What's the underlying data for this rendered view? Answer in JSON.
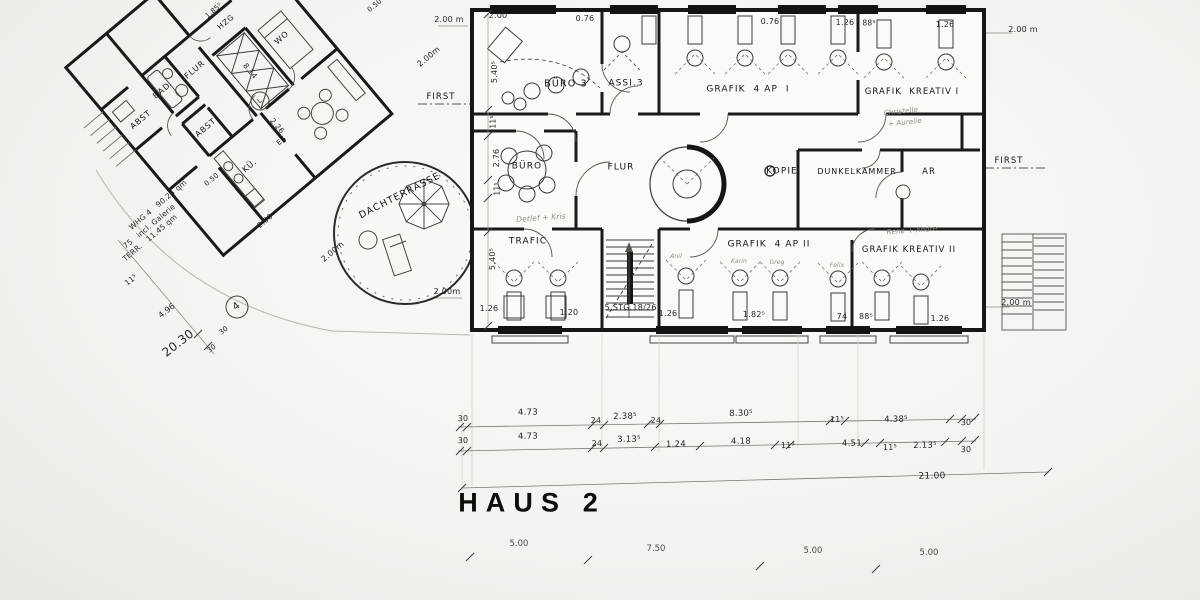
{
  "sheet": {
    "title": "HAUS 2"
  },
  "haus2": {
    "rooms": [
      "BÜRO 3",
      "ASSI.3",
      "GRAFIK 4 AP I",
      "GRAFIK KREATIV I",
      "BÜRO",
      "FLUR",
      "KOPIE",
      "DUNKELKAMMER",
      "AR",
      "TRAFIC",
      "GRAFIK 4 AP II",
      "GRAFIK KREATIV II"
    ],
    "stair_label": "15 STG.18/26",
    "total_width": "21.00",
    "dim_row_upper": [
      "30",
      "4.73",
      "24",
      "2.38⁵",
      "24",
      "8.30⁵",
      "11⁵",
      "4.38⁵",
      "30"
    ],
    "dim_row_lower": [
      "30",
      "4.73",
      "24",
      "3.13⁵",
      "1.24",
      "4.18",
      "11⁵",
      "4.51",
      "11⁵",
      "2.13⁵",
      "30"
    ],
    "grid_dims": [
      "5.00",
      "7.50",
      "5.00",
      "5.00"
    ]
  },
  "whg4": {
    "rooms": [
      "FLUR",
      "BAD",
      "ABST",
      "ABST",
      "KÜ.",
      "WO",
      "HZG",
      "ES",
      "DACHTERRASSE"
    ],
    "area_note": [
      "WHG 4   90.24 qm",
      "incl. Galerie",
      "TERR.   11.45 qm"
    ],
    "dims": [
      "75",
      "11⁵",
      "4.96",
      "20.30",
      "8.14",
      "2.26",
      "0.50",
      "2.00",
      "1.85⁵"
    ]
  },
  "ridge_label": "FIRST",
  "annotations": [
    {
      "name": "room-label-buero3",
      "text": "BÜRO 3",
      "x": 566,
      "y": 84,
      "rot": 0,
      "size": 9.5,
      "cls": "label"
    },
    {
      "name": "room-label-assi3",
      "text": "ASSI.3",
      "x": 626,
      "y": 84,
      "rot": 0,
      "size": 9,
      "cls": "label"
    },
    {
      "name": "room-label-grafik-4ap-1",
      "text": "GRAFIK  4 AP  I",
      "x": 748,
      "y": 90,
      "rot": 0,
      "size": 9,
      "cls": "label"
    },
    {
      "name": "room-label-grafik-kreativ-1",
      "text": "GRAFIK  KREATIV I",
      "x": 912,
      "y": 92,
      "rot": 0,
      "size": 8.5,
      "cls": "label"
    },
    {
      "name": "room-label-buero",
      "text": "BÜRO",
      "x": 527,
      "y": 167,
      "rot": 0,
      "size": 9,
      "cls": "label"
    },
    {
      "name": "room-label-flur-haus2",
      "text": "FLUR",
      "x": 621,
      "y": 168,
      "rot": 0,
      "size": 9,
      "cls": "label"
    },
    {
      "name": "room-label-kopie",
      "text": "KOPIE",
      "x": 782,
      "y": 172,
      "rot": 0,
      "size": 9,
      "cls": "label"
    },
    {
      "name": "room-label-dunkelkammer",
      "text": "DUNKELKAMMER",
      "x": 857,
      "y": 172,
      "rot": 0,
      "size": 8,
      "cls": "label"
    },
    {
      "name": "room-label-ar",
      "text": "AR",
      "x": 929,
      "y": 172,
      "rot": 0,
      "size": 8.5,
      "cls": "label"
    },
    {
      "name": "room-label-trafic",
      "text": "TRAFIC",
      "x": 528,
      "y": 242,
      "rot": 0,
      "size": 9,
      "cls": "label"
    },
    {
      "name": "room-label-grafik-4ap-2",
      "text": "GRAFIK  4 AP II",
      "x": 769,
      "y": 245,
      "rot": 0,
      "size": 9,
      "cls": "label"
    },
    {
      "name": "room-label-grafik-kreativ-2",
      "text": "GRAFIK KREATIV II",
      "x": 909,
      "y": 250,
      "rot": 0,
      "size": 8.5,
      "cls": "label"
    },
    {
      "name": "stair-label",
      "text": "15 STG.18/26",
      "x": 628,
      "y": 308,
      "rot": 0,
      "size": 8,
      "cls": "dim"
    },
    {
      "name": "room-label-flur-whg",
      "text": "FLUR",
      "x": 195,
      "y": 70,
      "rot": -40,
      "size": 8,
      "cls": "label"
    },
    {
      "name": "room-label-bad",
      "text": "BAD",
      "x": 162,
      "y": 91,
      "rot": -40,
      "size": 8,
      "cls": "label"
    },
    {
      "name": "room-label-abst-1",
      "text": "ABST",
      "x": 141,
      "y": 120,
      "rot": -40,
      "size": 8,
      "cls": "label"
    },
    {
      "name": "room-label-abst-2",
      "text": "ABST",
      "x": 206,
      "y": 128,
      "rot": -40,
      "size": 8,
      "cls": "label"
    },
    {
      "name": "room-label-kueche",
      "text": "KÜ.",
      "x": 250,
      "y": 166,
      "rot": -40,
      "size": 8,
      "cls": "label"
    },
    {
      "name": "room-label-wo",
      "text": "WO",
      "x": 282,
      "y": 38,
      "rot": -40,
      "size": 8,
      "cls": "label"
    },
    {
      "name": "room-label-hzg",
      "text": "HZG",
      "x": 226,
      "y": 22,
      "rot": -40,
      "size": 7.5,
      "cls": "label"
    },
    {
      "name": "room-label-es",
      "text": "ES",
      "x": 282,
      "y": 141,
      "rot": -40,
      "size": 7,
      "cls": "label"
    },
    {
      "name": "terrace-label",
      "text": "DACHTERRASSE",
      "x": 400,
      "y": 196,
      "rot": -27,
      "size": 9.5,
      "cls": "label"
    },
    {
      "name": "whg-area-line1",
      "text": "WHG 4   90.24 qm",
      "x": 158,
      "y": 205,
      "rot": -40,
      "size": 7.5,
      "cls": "dim"
    },
    {
      "name": "whg-area-line2",
      "text": "incl. Galerie",
      "x": 156,
      "y": 221,
      "rot": -40,
      "size": 7.5,
      "cls": "dim"
    },
    {
      "name": "whg-area-line3",
      "text": "TERR.   11.45 qm",
      "x": 150,
      "y": 238,
      "rot": -40,
      "size": 7.5,
      "cls": "dim"
    },
    {
      "name": "sheet-title",
      "text": "HAUS 2",
      "x": 532,
      "y": 503,
      "rot": 0,
      "size": 27,
      "cls": "title"
    },
    {
      "name": "dim-top-1",
      "text": "2.00",
      "x": 498,
      "y": 16,
      "rot": 0,
      "size": 8,
      "cls": "dim"
    },
    {
      "name": "dim-top-2",
      "text": "0.76",
      "x": 585,
      "y": 19,
      "rot": 0,
      "size": 8,
      "cls": "dim"
    },
    {
      "name": "dim-top-3",
      "text": "0.76",
      "x": 770,
      "y": 22,
      "rot": 0,
      "size": 8,
      "cls": "dim"
    },
    {
      "name": "dim-top-4",
      "text": "1.26",
      "x": 845,
      "y": 23,
      "rot": 0,
      "size": 8,
      "cls": "dim"
    },
    {
      "name": "dim-top-5",
      "text": "88⁵",
      "x": 869,
      "y": 23,
      "rot": 0,
      "size": 7.5,
      "cls": "dim"
    },
    {
      "name": "dim-top-6",
      "text": "1.26",
      "x": 945,
      "y": 25,
      "rot": 0,
      "size": 8,
      "cls": "dim"
    },
    {
      "name": "dim-west-1",
      "text": "5.40⁵",
      "x": 495,
      "y": 72,
      "rot": -90,
      "size": 8,
      "cls": "dim"
    },
    {
      "name": "dim-west-2",
      "text": "11⁵",
      "x": 493,
      "y": 122,
      "rot": -90,
      "size": 7.5,
      "cls": "dim"
    },
    {
      "name": "dim-west-3",
      "text": "2.76",
      "x": 497,
      "y": 158,
      "rot": -90,
      "size": 8,
      "cls": "dim"
    },
    {
      "name": "dim-west-4",
      "text": "11⁵",
      "x": 497,
      "y": 189,
      "rot": -90,
      "size": 7.5,
      "cls": "dim"
    },
    {
      "name": "dim-west-5",
      "text": "5.40⁵",
      "x": 493,
      "y": 259,
      "rot": -90,
      "size": 8,
      "cls": "dim"
    },
    {
      "name": "dim-south-1",
      "text": "1.26",
      "x": 489,
      "y": 309,
      "rot": 0,
      "size": 8,
      "cls": "dim"
    },
    {
      "name": "dim-south-2",
      "text": "1.20",
      "x": 569,
      "y": 313,
      "rot": 0,
      "size": 8,
      "cls": "dim"
    },
    {
      "name": "dim-south-3",
      "text": "1.26",
      "x": 668,
      "y": 314,
      "rot": 0,
      "size": 8,
      "cls": "dim"
    },
    {
      "name": "dim-south-4",
      "text": "1.82⁵",
      "x": 754,
      "y": 315,
      "rot": 0,
      "size": 8,
      "cls": "dim"
    },
    {
      "name": "dim-south-5",
      "text": "74",
      "x": 842,
      "y": 317,
      "rot": 0,
      "size": 8,
      "cls": "dim"
    },
    {
      "name": "dim-south-6",
      "text": "88⁵",
      "x": 866,
      "y": 317,
      "rot": 0,
      "size": 8,
      "cls": "dim"
    },
    {
      "name": "dim-south-7",
      "text": "1.26",
      "x": 940,
      "y": 319,
      "rot": 0,
      "size": 8,
      "cls": "dim"
    },
    {
      "name": "dimrow1-1",
      "text": "30",
      "x": 463,
      "y": 419,
      "rot": -1,
      "size": 8,
      "cls": "dim"
    },
    {
      "name": "dimrow1-2",
      "text": "4.73",
      "x": 528,
      "y": 413,
      "rot": -1,
      "size": 8.5,
      "cls": "dim"
    },
    {
      "name": "dimrow1-3",
      "text": "24",
      "x": 596,
      "y": 421,
      "rot": -1,
      "size": 8,
      "cls": "dim"
    },
    {
      "name": "dimrow1-4",
      "text": "2.38⁵",
      "x": 625,
      "y": 417,
      "rot": -1,
      "size": 8.5,
      "cls": "dim"
    },
    {
      "name": "dimrow1-5",
      "text": "24",
      "x": 656,
      "y": 421,
      "rot": -1,
      "size": 8,
      "cls": "dim"
    },
    {
      "name": "dimrow1-6",
      "text": "8.30⁵",
      "x": 741,
      "y": 414,
      "rot": -1,
      "size": 8.5,
      "cls": "dim"
    },
    {
      "name": "dimrow1-7",
      "text": "11⁵",
      "x": 837,
      "y": 420,
      "rot": -1,
      "size": 8,
      "cls": "dim"
    },
    {
      "name": "dimrow1-8",
      "text": "4.38⁵",
      "x": 896,
      "y": 420,
      "rot": -1,
      "size": 8.5,
      "cls": "dim"
    },
    {
      "name": "dimrow1-9",
      "text": "30",
      "x": 966,
      "y": 423,
      "rot": -1,
      "size": 8,
      "cls": "dim"
    },
    {
      "name": "dimrow2-1",
      "text": "30",
      "x": 463,
      "y": 441,
      "rot": -1,
      "size": 8,
      "cls": "dim"
    },
    {
      "name": "dimrow2-2",
      "text": "4.73",
      "x": 528,
      "y": 437,
      "rot": -1,
      "size": 8.5,
      "cls": "dim"
    },
    {
      "name": "dimrow2-3",
      "text": "24",
      "x": 597,
      "y": 444,
      "rot": -1,
      "size": 8,
      "cls": "dim"
    },
    {
      "name": "dimrow2-4",
      "text": "3.13⁵",
      "x": 629,
      "y": 440,
      "rot": -1,
      "size": 8.5,
      "cls": "dim"
    },
    {
      "name": "dimrow2-5",
      "text": "1.24",
      "x": 676,
      "y": 445,
      "rot": -1,
      "size": 8.5,
      "cls": "dim"
    },
    {
      "name": "dimrow2-6",
      "text": "4.18",
      "x": 741,
      "y": 442,
      "rot": -1,
      "size": 8.5,
      "cls": "dim"
    },
    {
      "name": "dimrow2-7",
      "text": "11⁵",
      "x": 788,
      "y": 446,
      "rot": -1,
      "size": 8,
      "cls": "dim"
    },
    {
      "name": "dimrow2-8",
      "text": "4.51",
      "x": 852,
      "y": 444,
      "rot": -1,
      "size": 8.5,
      "cls": "dim"
    },
    {
      "name": "dimrow2-9",
      "text": "11⁵",
      "x": 890,
      "y": 448,
      "rot": -1,
      "size": 8,
      "cls": "dim"
    },
    {
      "name": "dimrow2-10",
      "text": "2.13⁵",
      "x": 925,
      "y": 446,
      "rot": -1,
      "size": 8.5,
      "cls": "dim"
    },
    {
      "name": "dimrow2-11",
      "text": "30",
      "x": 966,
      "y": 450,
      "rot": -1,
      "size": 8,
      "cls": "dim"
    },
    {
      "name": "dim-total",
      "text": "21.00",
      "x": 932,
      "y": 477,
      "rot": -1,
      "size": 9,
      "cls": "dim"
    },
    {
      "name": "grid-dim-1",
      "text": "5.00",
      "x": 519,
      "y": 544,
      "rot": 0,
      "size": 8.5,
      "cls": "faint"
    },
    {
      "name": "grid-dim-2",
      "text": "7.50",
      "x": 656,
      "y": 549,
      "rot": 0,
      "size": 8.5,
      "cls": "faint"
    },
    {
      "name": "grid-dim-3",
      "text": "5.00",
      "x": 813,
      "y": 551,
      "rot": 0,
      "size": 8.5,
      "cls": "faint"
    },
    {
      "name": "grid-dim-4",
      "text": "5.00",
      "x": 929,
      "y": 553,
      "rot": 0,
      "size": 8.5,
      "cls": "faint"
    },
    {
      "name": "meter-nw-1",
      "text": "2.00 m",
      "x": 449,
      "y": 20,
      "rot": 0,
      "size": 8,
      "cls": "dim"
    },
    {
      "name": "meter-nw-2",
      "text": "2.00m",
      "x": 429,
      "y": 57,
      "rot": -40,
      "size": 8,
      "cls": "dim"
    },
    {
      "name": "meter-ne",
      "text": "2.00 m",
      "x": 1023,
      "y": 30,
      "rot": 0,
      "size": 8,
      "cls": "dim"
    },
    {
      "name": "meter-se",
      "text": "2.00 m",
      "x": 1016,
      "y": 303,
      "rot": 0,
      "size": 8,
      "cls": "dim"
    },
    {
      "name": "meter-terrace",
      "text": "2.00m",
      "x": 447,
      "y": 292,
      "rot": 0,
      "size": 8,
      "cls": "dim"
    },
    {
      "name": "meter-sw",
      "text": "2.00m",
      "x": 333,
      "y": 252,
      "rot": -40,
      "size": 8,
      "cls": "dim"
    },
    {
      "name": "dim-whg-200",
      "text": "2.00",
      "x": 265,
      "y": 221,
      "rot": -40,
      "size": 7.5,
      "cls": "dim"
    },
    {
      "name": "dim-whg-050a",
      "text": "0.50",
      "x": 212,
      "y": 180,
      "rot": -40,
      "size": 7,
      "cls": "dim"
    },
    {
      "name": "dim-whg-050b",
      "text": "0.50",
      "x": 375,
      "y": 6,
      "rot": -40,
      "size": 7,
      "cls": "dim"
    },
    {
      "name": "dim-whg-814",
      "text": "8.14",
      "x": 250,
      "y": 71,
      "rot": 50,
      "size": 7.5,
      "cls": "dim"
    },
    {
      "name": "dim-whg-226",
      "text": "2.26",
      "x": 277,
      "y": 126,
      "rot": 50,
      "size": 7.5,
      "cls": "dim"
    },
    {
      "name": "dim-whg-185",
      "text": "1.85⁵",
      "x": 214,
      "y": 11,
      "rot": -40,
      "size": 7,
      "cls": "dim"
    },
    {
      "name": "ridge-label-west",
      "text": "FIRST",
      "x": 441,
      "y": 97,
      "rot": 0,
      "size": 8.5,
      "cls": "label"
    },
    {
      "name": "ridge-label-east",
      "text": "FIRST",
      "x": 1009,
      "y": 161,
      "rot": 0,
      "size": 8.5,
      "cls": "label"
    },
    {
      "name": "dim-site-75",
      "text": "75",
      "x": 128,
      "y": 244,
      "rot": -38,
      "size": 7.5,
      "cls": "dim"
    },
    {
      "name": "dim-site-115",
      "text": "11⁵",
      "x": 131,
      "y": 280,
      "rot": -38,
      "size": 7.5,
      "cls": "dim"
    },
    {
      "name": "dim-site-496",
      "text": "4.96",
      "x": 167,
      "y": 311,
      "rot": -38,
      "size": 8,
      "cls": "dim"
    },
    {
      "name": "dim-site-2030",
      "text": "20.30",
      "x": 178,
      "y": 343,
      "rot": -38,
      "size": 12,
      "cls": "dim"
    },
    {
      "name": "dim-site-30a",
      "text": "30",
      "x": 224,
      "y": 331,
      "rot": -38,
      "size": 7,
      "cls": "dim"
    },
    {
      "name": "dim-site-30b",
      "text": "30",
      "x": 212,
      "y": 349,
      "rot": -38,
      "size": 7,
      "cls": "dim"
    },
    {
      "name": "marker-l",
      "text": "L",
      "x": 260,
      "y": 101,
      "rot": -40,
      "size": 7,
      "cls": "dim"
    },
    {
      "name": "marker-4",
      "text": "4",
      "x": 237,
      "y": 307,
      "rot": -38,
      "size": 10,
      "cls": "dim"
    },
    {
      "name": "handwriting-trafic",
      "text": "Detlef + Kris",
      "x": 541,
      "y": 218,
      "rot": -4,
      "size": 7.5,
      "cls": "hand"
    },
    {
      "name": "handwriting-kreativ1-a",
      "text": "Christelle",
      "x": 901,
      "y": 112,
      "rot": -6,
      "size": 7,
      "cls": "hand"
    },
    {
      "name": "handwriting-kreativ1-b",
      "text": "+ Aurelie",
      "x": 905,
      "y": 123,
      "rot": -6,
      "size": 7,
      "cls": "hand"
    },
    {
      "name": "handwriting-kreativ2",
      "text": "Rene + Andre",
      "x": 912,
      "y": 231,
      "rot": -4,
      "size": 7,
      "cls": "hand"
    },
    {
      "name": "handwriting-desk-1",
      "text": "Anil",
      "x": 676,
      "y": 257,
      "rot": 0,
      "size": 6,
      "cls": "hand"
    },
    {
      "name": "handwriting-desk-2",
      "text": "Karin",
      "x": 739,
      "y": 262,
      "rot": 0,
      "size": 6,
      "cls": "hand"
    },
    {
      "name": "handwriting-desk-3",
      "text": "Greg",
      "x": 777,
      "y": 263,
      "rot": 0,
      "size": 6,
      "cls": "hand"
    },
    {
      "name": "handwriting-desk-4",
      "text": "Felix",
      "x": 837,
      "y": 266,
      "rot": 0,
      "size": 6,
      "cls": "hand"
    }
  ]
}
